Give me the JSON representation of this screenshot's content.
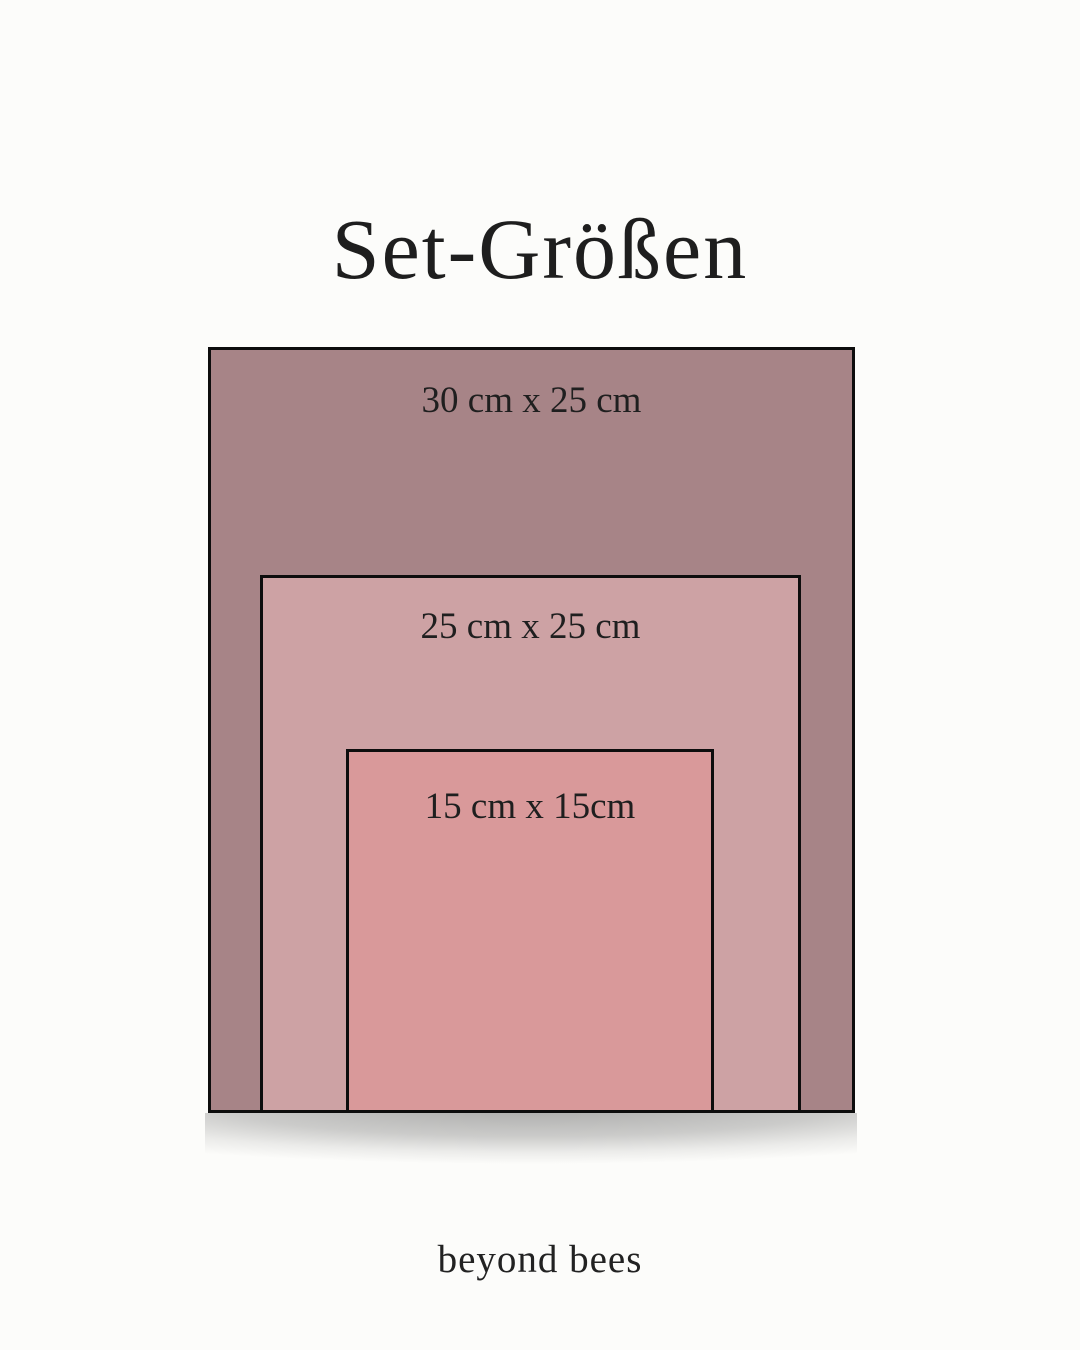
{
  "header": {
    "title": "Set-Größen"
  },
  "footer": {
    "brand": "beyond bees"
  },
  "page": {
    "background": "#fcfcfa",
    "text_color": "#1e1e1e",
    "border_color": "#0d0d0d"
  },
  "chart_data": {
    "type": "nested-rectangles-size-comparison",
    "title": "Set-Größen",
    "items": [
      {
        "label": "30 cm x 25 cm",
        "width_cm": 30,
        "height_cm": 25,
        "color": "#a78487"
      },
      {
        "label": "25 cm x 25 cm",
        "width_cm": 25,
        "height_cm": 25,
        "color": "#cda2a4"
      },
      {
        "label": "15 cm x 15cm",
        "width_cm": 15,
        "height_cm": 15,
        "color": "#d9999a"
      }
    ],
    "layout_hint": "rectangles nested, horizontally centered, bottom-aligned, soft shadow below"
  }
}
